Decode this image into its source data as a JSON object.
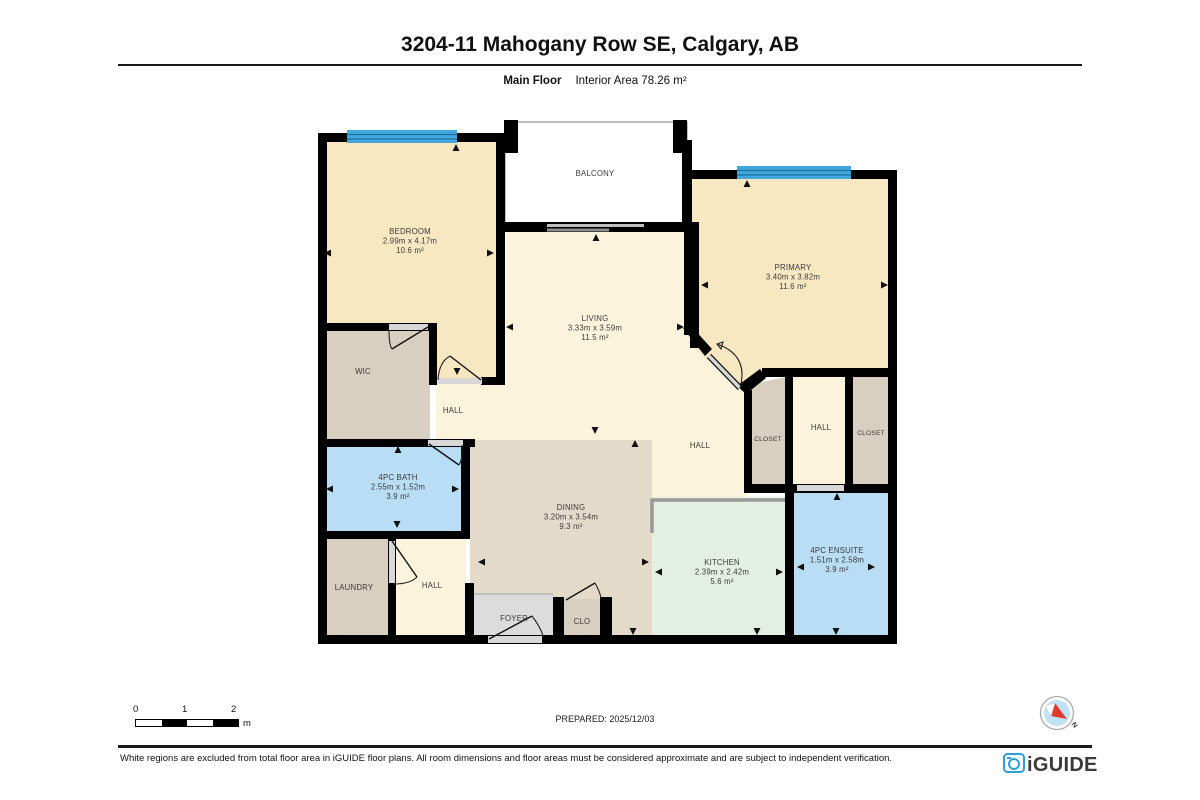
{
  "header": {
    "title": "3204-11 Mahogany Row SE, Calgary, AB",
    "floor_label": "Main Floor",
    "area_label": "Interior Area 78.26 m²"
  },
  "rooms": {
    "balcony": {
      "name": "BALCONY"
    },
    "bedroom": {
      "name": "BEDROOM",
      "dims": "2.99m x 4.17m",
      "area": "10.6 m²"
    },
    "primary": {
      "name": "PRIMARY",
      "dims": "3.40m x 3.82m",
      "area": "11.6 m²"
    },
    "living": {
      "name": "LIVING",
      "dims": "3.33m x 3.59m",
      "area": "11.5 m²"
    },
    "wic": {
      "name": "WIC"
    },
    "hall_upper": {
      "name": "HALL"
    },
    "bath": {
      "name": "4PC BATH",
      "dims": "2.55m x 1.52m",
      "area": "3.9 m²"
    },
    "laundry": {
      "name": "LAUNDRY"
    },
    "hall_lower": {
      "name": "HALL"
    },
    "dining": {
      "name": "DINING",
      "dims": "3.20m x 3.54m",
      "area": "9.3 m²"
    },
    "foyer": {
      "name": "FOYER"
    },
    "clo": {
      "name": "CLO"
    },
    "kitchen": {
      "name": "KITCHEN",
      "dims": "2.39m x 2.42m",
      "area": "5.6 m²"
    },
    "hall_center": {
      "name": "HALL"
    },
    "closet_left": {
      "name": "CLOSET"
    },
    "hall_right": {
      "name": "HALL"
    },
    "closet_right": {
      "name": "CLOSET"
    },
    "ensuite": {
      "name": "4PC ENSUITE",
      "dims": "1.51m x 2.58m",
      "area": "3.9 m²"
    }
  },
  "scale_bar": {
    "ticks": [
      "0",
      "1",
      "2"
    ],
    "unit": "m"
  },
  "footer": {
    "prepared": "PREPARED: 2025/12/03",
    "disclaimer": "White regions are excluded from total floor area in iGUIDE floor plans. All room dimensions and floor areas must be considered approximate and are subject to independent verification.",
    "brand": "iGUIDE",
    "compass_label": "N"
  },
  "colors": {
    "wall": "#000000",
    "window_blue": "#42A7DC",
    "window_line": "#1C6FA0",
    "room_wheat": "#F8E8C2",
    "room_cream": "#FBF3DB",
    "room_taupe": "#D9CFC1",
    "room_beige": "#E4DACA",
    "room_green": "#E4EFE3",
    "room_blue": "#B9DDF4",
    "room_gray": "#DCDCDC",
    "balcony_white": "#FFFFFF",
    "brand_blue": "#2D9FD8",
    "compass_red": "#E03A2F"
  }
}
